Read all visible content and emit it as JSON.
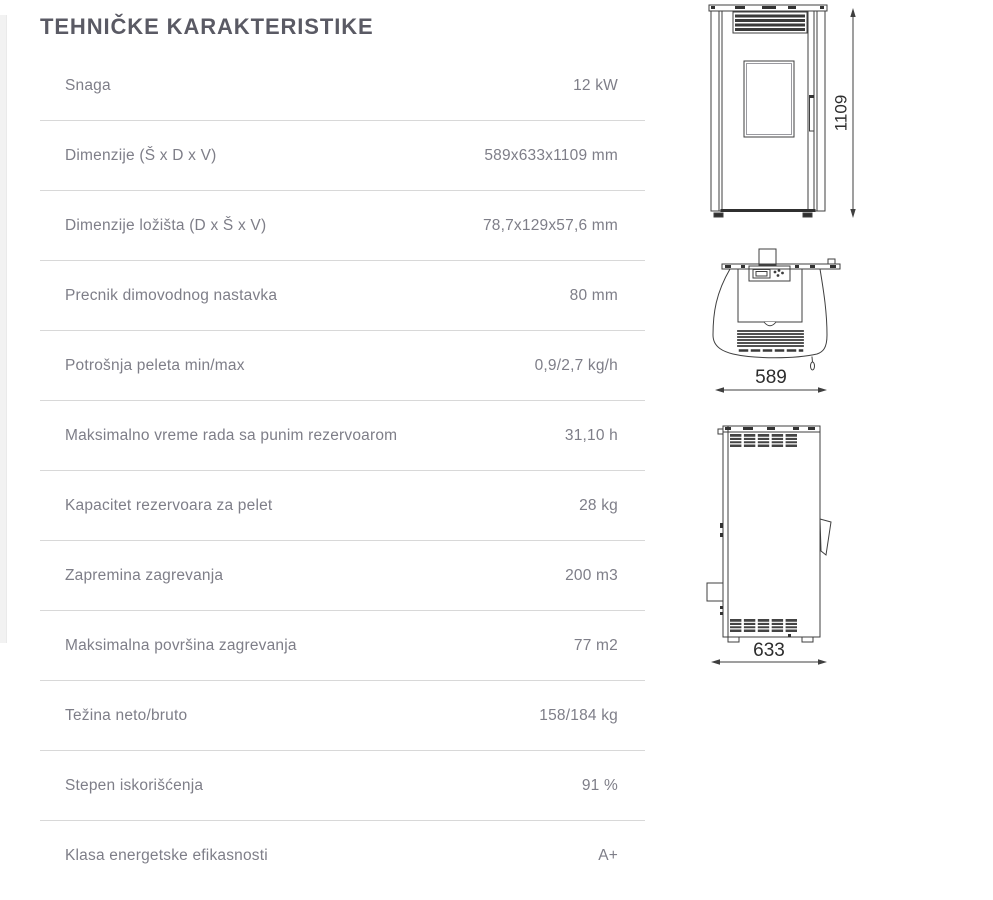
{
  "page": {
    "title": "TEHNIČKE KARAKTERISTIKE"
  },
  "table": {
    "rows": [
      {
        "label": "Snaga",
        "value": "12 kW"
      },
      {
        "label": "Dimenzije (Š x D x V)",
        "value": "589x633x1109 mm"
      },
      {
        "label": "Dimenzije ložišta (D x Š x V)",
        "value": "78,7x129x57,6 mm"
      },
      {
        "label": "Precnik dimovodnog nastavka",
        "value": "80 mm"
      },
      {
        "label": "Potrošnja peleta min/max",
        "value": "0,9/2,7 kg/h"
      },
      {
        "label": "Maksimalno vreme rada sa punim rezervoarom",
        "value": "31,10 h"
      },
      {
        "label": "Kapacitet rezervoara za pelet",
        "value": "28 kg"
      },
      {
        "label": "Zapremina zagrevanja",
        "value": "200 m3"
      },
      {
        "label": "Maksimalna površina zagrevanja",
        "value": "77 m2"
      },
      {
        "label": "Težina neto/bruto",
        "value": "158/184 kg"
      },
      {
        "label": "Stepen iskorišćenja",
        "value": "91 %"
      },
      {
        "label": "Klasa energetske efikasnosti",
        "value": "A+"
      }
    ]
  },
  "drawings": {
    "front_view": {
      "height_dim": "1109"
    },
    "top_view": {
      "width_dim": "589"
    },
    "side_view": {
      "depth_dim": "633"
    }
  },
  "colors": {
    "title_text": "#5a5a64",
    "body_text": "#7e7e88",
    "divider": "#d8d8d8",
    "drawing_line": "#3f3f3f"
  }
}
